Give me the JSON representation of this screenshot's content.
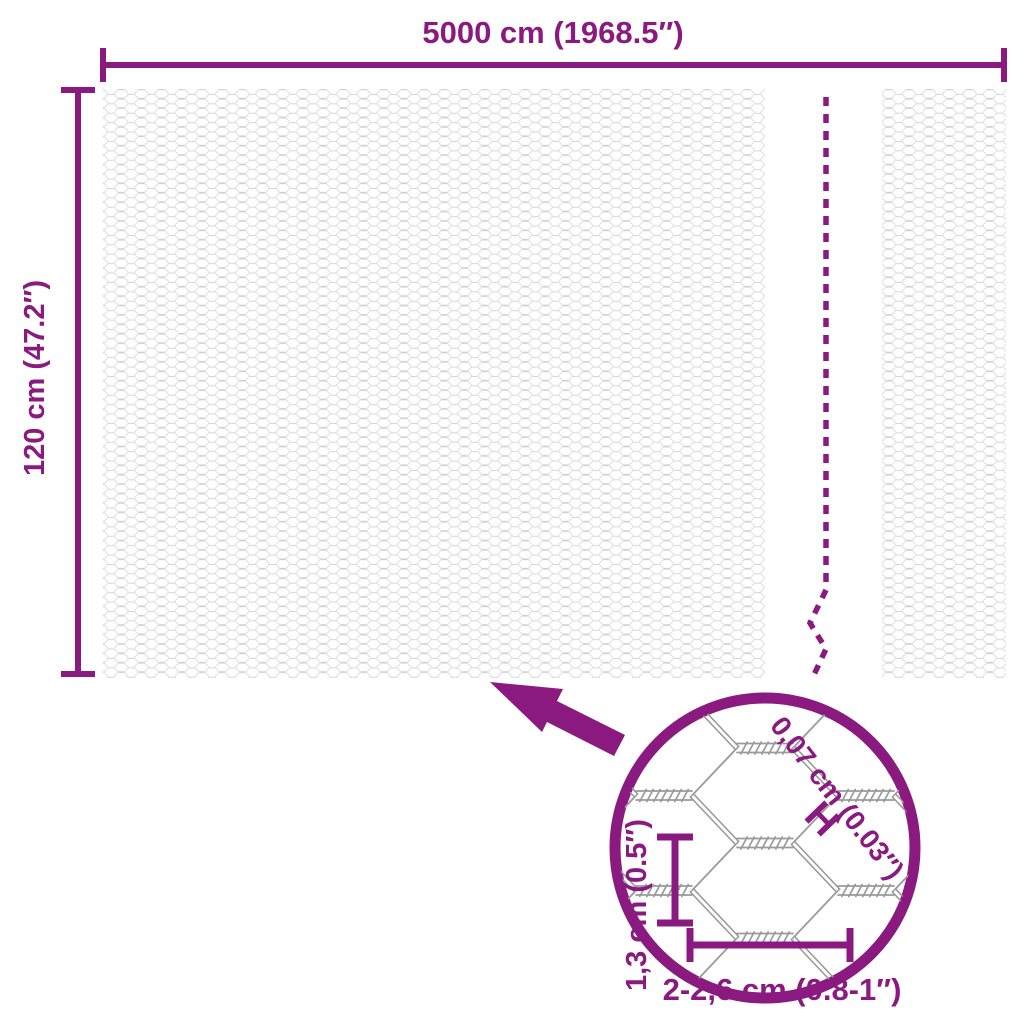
{
  "diagram": {
    "title_hint": "netting-roll-dimension-diagram",
    "width_dimension": {
      "label": "5000 cm (1968.5″)"
    },
    "height_dimension": {
      "label": "120 cm (47.2″)"
    },
    "detail": {
      "wire_thickness_label": "0,07 cm (0.03″)",
      "thickness_marker": "H",
      "mesh_height_label": "1,3 cm (0.5″)",
      "mesh_width_label": "2-2,6 cm (0.8-1″)"
    }
  },
  "colors": {
    "accent": "#8A1A80",
    "mesh_pattern_light": "#D6D6D6",
    "mesh_detail_gray": "#9A9A9A",
    "background": "#FFFFFF"
  }
}
